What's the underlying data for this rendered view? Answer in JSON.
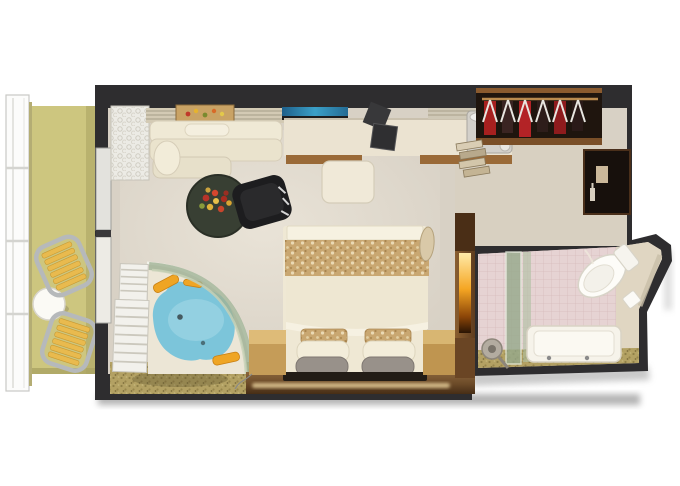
{
  "scene": {
    "type": "floorplan-3d-top-down-render",
    "rooms": [
      "balcony",
      "living-area",
      "bedroom",
      "walk-in-closet",
      "bathroom"
    ],
    "objects": [
      "balcony-railing",
      "balcony-chair",
      "balcony-table",
      "chaise-lounge",
      "wall-shelf",
      "food-tray",
      "tv-screen",
      "desk",
      "desk-items",
      "ice-bucket",
      "stool",
      "coffee-table",
      "flower-bowl",
      "armchair",
      "bed",
      "bed-throw",
      "pillows",
      "nightstand",
      "whirlpool-tub",
      "glass-enclosure",
      "louver-shutters",
      "mosaic-floor",
      "wardrobe",
      "hangers",
      "garments",
      "towel-shelf",
      "minibar-cabinet",
      "divider-wall",
      "light-niche",
      "bathrobe",
      "tile-wall",
      "shower-glass",
      "shower-head",
      "bathtub",
      "toilet"
    ]
  },
  "palette": {
    "wall": "#2e2d2f",
    "carpet": "#d8d1c5",
    "closet_carpet": "#d9d0bd",
    "balcony_floor": "#cdc67f",
    "bed_linen": "#efe8d4",
    "throw_tan": "#c9a771",
    "water_blue": "#7cc5da",
    "glass_green": "#9fb295",
    "accent_orange": "#efa524",
    "wood_dark": "#5e3c1e",
    "wood_light": "#c59c58",
    "tile_pink": "#e6d3d3",
    "mosaic_gold": "#b3a163",
    "fixture_white": "#f6f3ea",
    "garment_red": "#a7201f",
    "desk_cream": "#ebe3d1",
    "pillow_gray": "#98918a",
    "shadow_gray": "#9a9a9a",
    "bath_floor": "#e9dfd4",
    "tub_deck": "#ece6d6"
  }
}
